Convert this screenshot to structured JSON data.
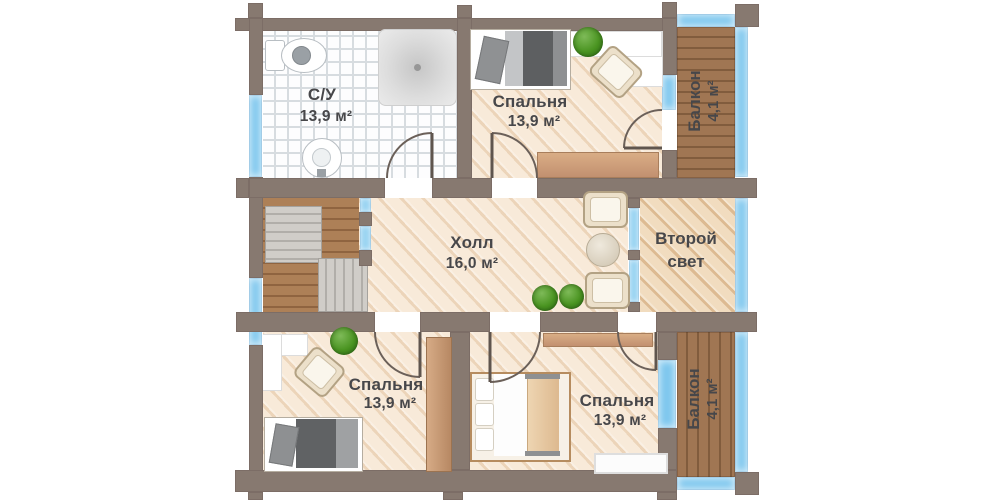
{
  "colors": {
    "wall": "#877970",
    "window": "#7ec7ee",
    "glass": "#9ad4f2",
    "floor": "#f8ead9",
    "floor2": "#f1dcbf",
    "text": "#47474a"
  },
  "rooms": {
    "bathroom": {
      "name": "С/У",
      "area": "13,9 м²"
    },
    "bedroom_top": {
      "name": "Спальня",
      "area": "13,9 м²"
    },
    "balcony_top": {
      "name": "Балкон",
      "area": "4,1 м²"
    },
    "hall": {
      "name": "Холл",
      "area": "16,0 м²"
    },
    "second_light": {
      "name": "Второй свет"
    },
    "bedroom_left": {
      "name": "Спальня",
      "area": "13,9 м²"
    },
    "bedroom_bottom": {
      "name": "Спальня",
      "area": "13,9 м²"
    },
    "balcony_bottom": {
      "name": "Балкон",
      "area": "4,1 м²"
    }
  }
}
